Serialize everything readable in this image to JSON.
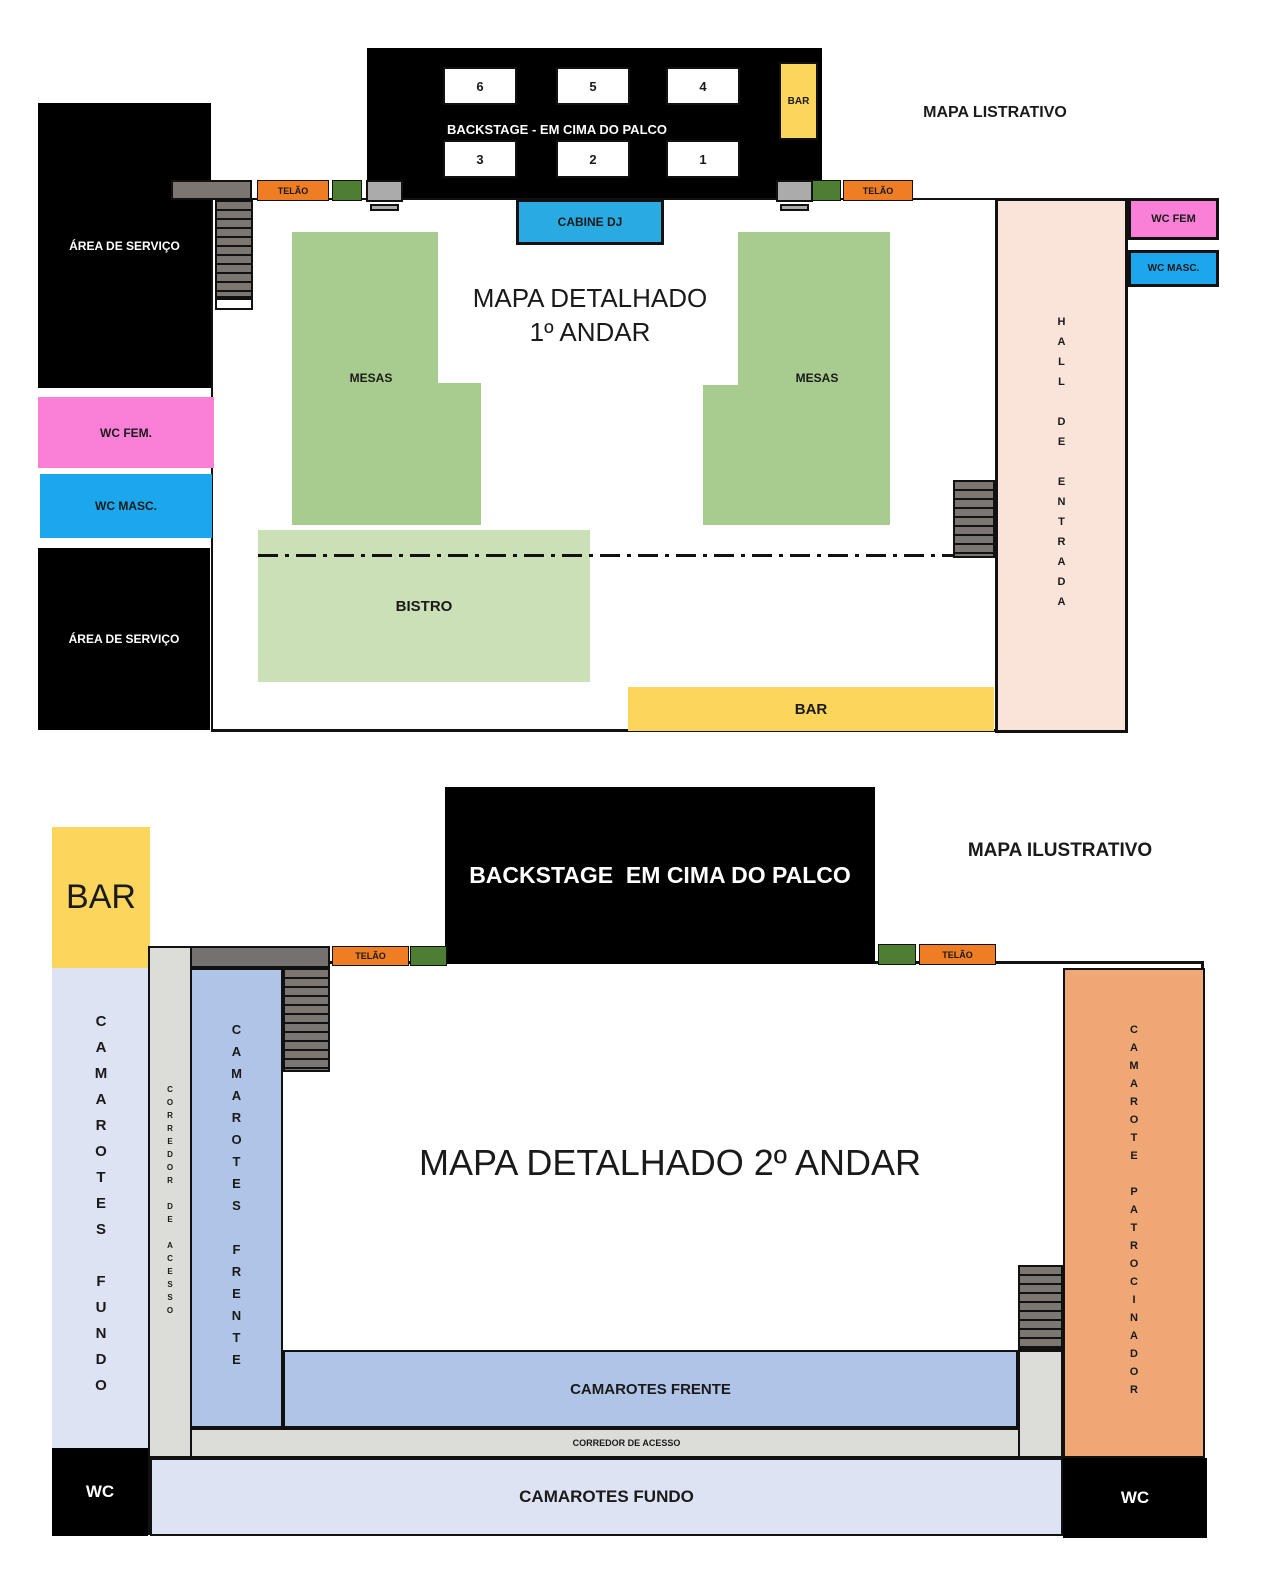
{
  "floor1": {
    "watermark": "MAPA LISTRATIVO",
    "title_line1": "MAPA DETALHADO",
    "title_line2": "1º ANDAR",
    "stage": {
      "label": "BACKSTAGE - EM CIMA DO PALCO",
      "boxes_top": [
        "6",
        "5",
        "4"
      ],
      "boxes_bottom": [
        "3",
        "2",
        "1"
      ],
      "bar_label": "BAR"
    },
    "cabine_dj": "CABINE DJ",
    "telao_left": "TELÃO",
    "telao_right": "TELÃO",
    "servico_top": "ÁREA DE SERVIÇO",
    "wc_fem_left": "WC FEM.",
    "wc_masc_left": "WC MASC.",
    "servico_bottom": "ÁREA DE SERVIÇO",
    "mesas_left": "MESAS",
    "mesas_right": "MESAS",
    "bistro": "BISTRO",
    "bar_bottom": "BAR",
    "hall": "HALL DE ENTRADA",
    "wc_fem_right": "WC FEM",
    "wc_masc_right": "WC MASC."
  },
  "floor2": {
    "watermark": "MAPA ILUSTRATIVO",
    "title": "MAPA DETALHADO 2º ANDAR",
    "stage_label": "BACKSTAGE  EM CIMA DO PALCO",
    "bar": "BAR",
    "telao_left": "TELÃO",
    "telao_right": "TELÃO",
    "camarotes_fundo_column": "CAMAROTES FUNDO",
    "corredor_column": "CORREDOR DE ACESSO",
    "camarotes_frente_column": "CAMAROTES FRENTE",
    "camarote_patrocinador": "CAMAROTE PATROCINADOR",
    "camarotes_frente_band": "CAMAROTES FRENTE",
    "corredor_band": "CORREDOR DE ACESSO",
    "camarotes_fundo_band": "CAMAROTES FUNDO",
    "wc_left": "WC",
    "wc_right": "WC"
  },
  "colors": {
    "black": "#000000",
    "stage_text": "#ffffff",
    "yellow_bar": "#FBD55C",
    "orange_telao": "#EE7D23",
    "dark_green": "#4E7E33",
    "mesas_green": "#A8CC8F",
    "bistro_green": "#CCE0B8",
    "dj_blue": "#29ABE2",
    "wc_masc_blue": "#1CA7EC",
    "wc_fem_pink": "#FA80D7",
    "hall_peach": "#FAE3D8",
    "stairs_gray": "#7B7672",
    "speaker_gray": "#ABABAB",
    "camarotes_fundo_lavender": "#DDE3F3",
    "camarotes_frente_blue": "#AFC4E6",
    "corridor_gray": "#DCDCD8",
    "landing_dark_gray": "#767171",
    "patrocinador_salmon": "#F0A776"
  }
}
